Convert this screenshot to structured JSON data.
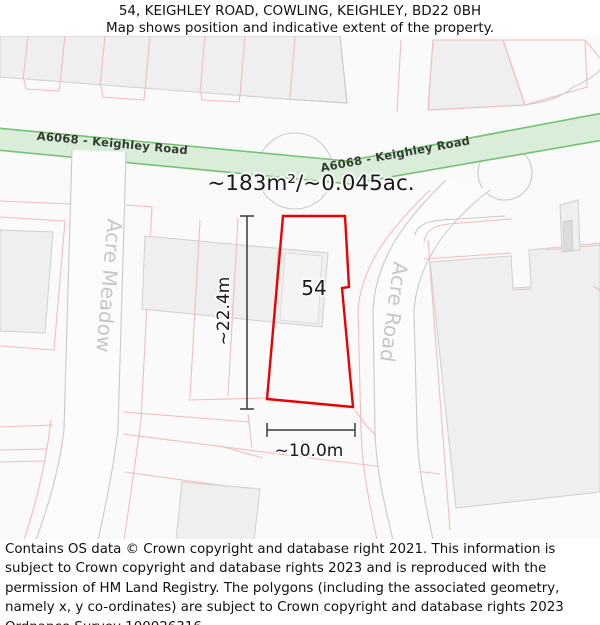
{
  "header": {
    "title": "54, KEIGHLEY ROAD, COWLING, KEIGHLEY, BD22 0BH",
    "subtitle": "Map shows position and indicative extent of the property."
  },
  "map": {
    "area_label": "~183m²/~0.045ac.",
    "plot_number": "54",
    "width_label": "~10.0m",
    "height_label": "~22.4m",
    "roads": {
      "main_road": "A6068 - Keighley Road",
      "left_road": "Acre Meadow",
      "right_road": "Acre Road"
    },
    "colors": {
      "property_outline": "#ee0000",
      "road_band_fill": "#d9edd9",
      "road_band_border": "#74c274",
      "parcel_boundary": "#f4bcbc",
      "building_fill": "#efefef",
      "map_line_gray": "#c9c9c9",
      "road_name_text": "#c6c6c6"
    }
  },
  "footer": {
    "text": "Contains OS data © Crown copyright and database right 2021. This information is subject to Crown copyright and database rights 2023 and is reproduced with the permission of HM Land Registry. The polygons (including the associated geometry, namely x, y co-ordinates) are subject to Crown copyright and database rights 2023 Ordnance Survey 100026316."
  }
}
